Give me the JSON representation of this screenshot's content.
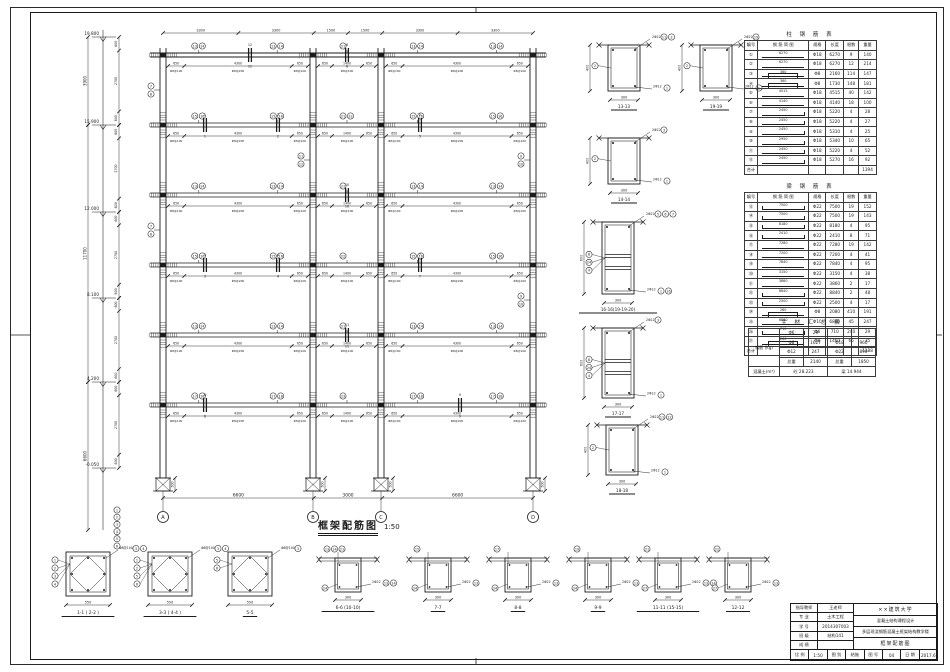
{
  "sheet": {
    "bg": "#ffffff",
    "line_color": "#1b1b1b"
  },
  "drawing_title": {
    "text": "框架配筋图",
    "scale": "1:50"
  },
  "axes": {
    "ids": [
      "A",
      "B",
      "C",
      "D"
    ],
    "x": [
      163,
      313,
      381,
      533
    ],
    "span_labels": [
      "6600",
      "3000",
      "6600"
    ],
    "top_segs": [
      "3300",
      "3300",
      "1500",
      "1500",
      "3300",
      "3300"
    ]
  },
  "levels": [
    {
      "y": 37,
      "label": "19.800"
    },
    {
      "y": 125,
      "label": "15.900"
    },
    {
      "y": 212,
      "label": "12.000"
    },
    {
      "y": 298,
      "label": "8.100"
    },
    {
      "y": 382,
      "label": "4.200"
    },
    {
      "y": 468,
      "label": "-0.050"
    }
  ],
  "left_total_dims": [
    {
      "y1": 37,
      "y2": 125,
      "label": "3900"
    },
    {
      "y1": 125,
      "y2": 382,
      "label": "11700"
    },
    {
      "y1": 382,
      "y2": 530,
      "label": "6600"
    }
  ],
  "story_sub_dims": [
    "600",
    "2700",
    "600"
  ],
  "beams": {
    "y": [
      55,
      125,
      195,
      265,
      335,
      405
    ],
    "x1": 150,
    "x2": 546,
    "col_top": 48,
    "col_bottom": 478,
    "side_dims": [
      "650",
      "4300",
      "650"
    ],
    "mid_dims": [
      "650",
      "1400",
      "650"
    ],
    "stirrups": [
      "Φ8@100",
      "Φ8@200",
      "Φ8@100"
    ],
    "marks": [
      [
        [
          "13",
          "14"
        ],
        [
          "21"
        ],
        [
          "13",
          "14"
        ]
      ],
      [
        [
          "15",
          "16"
        ],
        [
          "21",
          "22"
        ],
        [
          "15",
          "16"
        ]
      ],
      [
        [
          "13",
          "14"
        ],
        [
          "21"
        ],
        [
          "13",
          "14"
        ]
      ],
      [
        [
          "15",
          "16"
        ],
        [
          "22"
        ],
        [
          "15",
          "16"
        ]
      ],
      [
        [
          "13",
          "14"
        ],
        [
          "21"
        ],
        [
          "13",
          "14"
        ]
      ],
      [
        [
          "17",
          "18"
        ],
        [
          "23"
        ],
        [
          "17",
          "18"
        ]
      ]
    ]
  },
  "cuts": [
    {
      "x": 205,
      "l": 1,
      "n": "1"
    },
    {
      "x": 278,
      "l": 1,
      "n": "2"
    },
    {
      "x": 205,
      "l": 3,
      "n": "3"
    },
    {
      "x": 278,
      "l": 3,
      "n": "4"
    },
    {
      "x": 420,
      "l": 1,
      "n": "5"
    },
    {
      "x": 347,
      "l": 0,
      "n": "6"
    },
    {
      "x": 420,
      "l": 3,
      "n": "7"
    },
    {
      "x": 205,
      "l": 5,
      "n": "8"
    },
    {
      "x": 460,
      "l": 5,
      "n": "9"
    },
    {
      "x": 347,
      "l": 2,
      "n": "10"
    },
    {
      "x": 347,
      "l": 4,
      "n": "11"
    },
    {
      "x": 250,
      "l": 0,
      "n": "12"
    }
  ],
  "col_marks": [
    {
      "x": 163,
      "story": 1,
      "nums": [
        "7",
        "8"
      ]
    },
    {
      "x": 163,
      "story": 3,
      "nums": [
        "7",
        "8"
      ]
    },
    {
      "x": 533,
      "story": 2,
      "nums": [
        "9",
        "10"
      ]
    },
    {
      "x": 533,
      "story": 4,
      "nums": [
        "9",
        "10"
      ]
    },
    {
      "x": 313,
      "story": 2,
      "nums": [
        "11",
        "12"
      ]
    }
  ],
  "axis_legend": [
    "1",
    "2",
    "3",
    "4",
    "5",
    "6"
  ],
  "foundation_dim": "500",
  "mid_sections": [
    {
      "label": "13-13",
      "x": 608,
      "y": 45,
      "w": 32,
      "h": 46,
      "hdim": "400",
      "wdim": "300",
      "top": "2Φ22",
      "topc": [
        "11",
        "3"
      ],
      "bot": "2Φ12",
      "botc": [
        "1"
      ],
      "leftc": [
        "2"
      ],
      "mid": false
    },
    {
      "label": "19-19",
      "x": 700,
      "y": 45,
      "w": 32,
      "h": 46,
      "hdim": "400",
      "wdim": "300",
      "top": "2Φ22",
      "topc": [
        "19"
      ],
      "bot": "2Φ12",
      "botc": [
        "1"
      ],
      "leftc": [
        "2"
      ],
      "mid": false
    },
    {
      "label": "14-14",
      "x": 608,
      "y": 138,
      "w": 32,
      "h": 46,
      "hdim": "400",
      "wdim": "300",
      "top": "2Φ22",
      "topc": [
        "3"
      ],
      "bot": "2Φ12",
      "botc": [
        "1"
      ],
      "leftc": [
        "2"
      ],
      "mid": false
    },
    {
      "label": "16-16(19-19-20)",
      "x": 602,
      "y": 222,
      "w": 32,
      "h": 72,
      "hdim": "600",
      "wdim": "300",
      "top": "2Φ22",
      "topc": [
        "5",
        "6",
        "7"
      ],
      "bot": "2Φ12",
      "botc": [
        "1",
        "16"
      ],
      "leftc": [
        "8",
        "24",
        "4"
      ],
      "mid": true
    },
    {
      "label": "17-17",
      "x": 602,
      "y": 328,
      "w": 32,
      "h": 70,
      "hdim": "600",
      "wdim": "300",
      "top": "2Φ22",
      "topc": [
        "3"
      ],
      "bot": "2Φ12",
      "botc": [
        "1"
      ],
      "leftc": [
        "8",
        "24",
        "4"
      ],
      "mid": true
    },
    {
      "label": "18-18",
      "x": 606,
      "y": 425,
      "w": 32,
      "h": 50,
      "hdim": "400",
      "wdim": "300",
      "top": "2Φ22",
      "topc": [
        "11",
        "12"
      ],
      "bot": "2Φ12",
      "botc": [
        "1"
      ],
      "leftc": [
        "2"
      ],
      "mid": false
    }
  ],
  "bottom_sections": [
    {
      "label": "1-1 ( 2-2 )",
      "cx": 88,
      "type": "column",
      "wdim": "550",
      "leftc": [
        "1",
        "2",
        "3",
        "4"
      ],
      "rightc": [
        "3",
        "4"
      ],
      "note": "Φ8@100"
    },
    {
      "label": "3-3 ( 4-4 )",
      "cx": 170,
      "type": "column",
      "wdim": "550",
      "leftc": [
        "1",
        "2",
        "5",
        "6"
      ],
      "rightc": [
        "3",
        "4"
      ],
      "note": "Φ8@100"
    },
    {
      "label": "5-5",
      "cx": 250,
      "type": "column",
      "wdim": "550",
      "leftc": [
        "5",
        "6"
      ],
      "rightc": [
        "3"
      ],
      "note": "Φ8@100"
    },
    {
      "label": "6-6 (10-10)",
      "cx": 348,
      "type": "beam",
      "wdim": "300",
      "topc": [
        "13",
        "14",
        "21"
      ],
      "rightc": [
        "13",
        "14"
      ],
      "leftc": [
        "24"
      ],
      "top": "2Φ22"
    },
    {
      "label": "7-7",
      "cx": 438,
      "type": "beam",
      "wdim": "300",
      "topc": [
        "15"
      ],
      "rightc": [
        "13"
      ],
      "leftc": [
        "24"
      ],
      "top": "2Φ22"
    },
    {
      "label": "8-8",
      "cx": 518,
      "type": "beam",
      "wdim": "300",
      "topc": [
        "17"
      ],
      "rightc": [
        "13"
      ],
      "leftc": [
        "24"
      ],
      "top": "2Φ22"
    },
    {
      "label": "9-9",
      "cx": 598,
      "type": "beam",
      "wdim": "300",
      "topc": [
        "19"
      ],
      "rightc": [
        "13"
      ],
      "leftc": [
        "24"
      ],
      "top": "2Φ22"
    },
    {
      "label": "11-11 (15-15)",
      "cx": 668,
      "type": "beam",
      "wdim": "300",
      "topc": [
        "21"
      ],
      "rightc": [
        "13",
        "14"
      ],
      "leftc": [
        "27"
      ],
      "top": "2Φ22"
    },
    {
      "label": "12-12",
      "cx": 738,
      "type": "beam",
      "wdim": "300",
      "topc": [
        "22"
      ],
      "rightc": [
        "13"
      ],
      "leftc": [
        "27"
      ],
      "top": "2Φ22"
    }
  ],
  "column_table": {
    "title": "柱 钢 筋 表",
    "x": 744,
    "y": 30,
    "headers": [
      "编号",
      "钢 筋 简 图",
      "规格",
      "长度",
      "根数",
      "重量"
    ],
    "rows": [
      {
        "no": "①",
        "shape": "line",
        "dlabel": "6270",
        "spec": "Φ18",
        "len": "6270",
        "cnt": "9",
        "wt": "140"
      },
      {
        "no": "②",
        "shape": "line",
        "dlabel": "6270",
        "spec": "Φ18",
        "len": "6270",
        "cnt": "12",
        "wt": "214"
      },
      {
        "no": "③",
        "shape": "stir",
        "dlabel": "360",
        "spec": "Φ8",
        "len": "2160",
        "cnt": "114",
        "wt": "147"
      },
      {
        "no": "④",
        "shape": "stir",
        "dlabel": "360",
        "spec": "Φ8",
        "len": "1730",
        "cnt": "148",
        "wt": "181"
      },
      {
        "no": "⑤",
        "shape": "line",
        "dlabel": "4515",
        "spec": "Φ18",
        "len": "4515",
        "cnt": "40",
        "wt": "142"
      },
      {
        "no": "⑥",
        "shape": "line",
        "dlabel": "4140",
        "spec": "Φ18",
        "len": "4140",
        "cnt": "18",
        "wt": "100"
      },
      {
        "no": "⑦",
        "shape": "hookR",
        "dlabel": "2450",
        "spec": "Φ18",
        "len": "5220",
        "cnt": "4",
        "wt": "28"
      },
      {
        "no": "⑧",
        "shape": "hookR",
        "dlabel": "2450",
        "spec": "Φ18",
        "len": "5220",
        "cnt": "4",
        "wt": "27"
      },
      {
        "no": "⑨",
        "shape": "hookR",
        "dlabel": "2450",
        "spec": "Φ18",
        "len": "5310",
        "cnt": "4",
        "wt": "25"
      },
      {
        "no": "⑩",
        "shape": "hookR",
        "dlabel": "2950",
        "spec": "Φ18",
        "len": "5340",
        "cnt": "10",
        "wt": "65"
      },
      {
        "no": "⑪",
        "shape": "hookR",
        "dlabel": "2450",
        "spec": "Φ18",
        "len": "5220",
        "cnt": "4",
        "wt": "52"
      },
      {
        "no": "⑫",
        "shape": "hookR",
        "dlabel": "2450",
        "spec": "Φ18",
        "len": "5270",
        "cnt": "16",
        "wt": "92"
      }
    ],
    "total_label": "合计",
    "total": "1394"
  },
  "beam_table": {
    "title": "梁 钢 筋 表",
    "x": 744,
    "y": 182,
    "headers": [
      "编号",
      "钢 筋 简 图",
      "规格",
      "长度",
      "根数",
      "重量"
    ],
    "rows": [
      {
        "no": "⑬",
        "shape": "hookLR",
        "dlabel": "7500",
        "spec": "Φ22",
        "len": "7500",
        "cnt": "19",
        "wt": "152"
      },
      {
        "no": "⑭",
        "shape": "hookLR",
        "dlabel": "7500",
        "spec": "Φ22",
        "len": "7500",
        "cnt": "19",
        "wt": "143"
      },
      {
        "no": "⑮",
        "shape": "hookLR",
        "dlabel": "8180",
        "spec": "Φ22",
        "len": "8180",
        "cnt": "4",
        "wt": "95"
      },
      {
        "no": "⑯",
        "shape": "hookLR",
        "dlabel": "2410",
        "spec": "Φ22",
        "len": "2410",
        "cnt": "8",
        "wt": "71"
      },
      {
        "no": "⑰",
        "shape": "line",
        "dlabel": "7280",
        "spec": "Φ22",
        "len": "7280",
        "cnt": "19",
        "wt": "142"
      },
      {
        "no": "⑱",
        "shape": "line",
        "dlabel": "7200",
        "spec": "Φ22",
        "len": "7200",
        "cnt": "4",
        "wt": "41"
      },
      {
        "no": "⑲",
        "shape": "line",
        "dlabel": "7840",
        "spec": "Φ22",
        "len": "7840",
        "cnt": "4",
        "wt": "95"
      },
      {
        "no": "⑳",
        "shape": "line",
        "dlabel": "3150",
        "spec": "Φ22",
        "len": "3150",
        "cnt": "4",
        "wt": "38"
      },
      {
        "no": "㉑",
        "shape": "line",
        "dlabel": "3860",
        "spec": "Φ22",
        "len": "3860",
        "cnt": "2",
        "wt": "17"
      },
      {
        "no": "㉒",
        "shape": "hookLR",
        "dlabel": "8840",
        "spec": "Φ22",
        "len": "8840",
        "cnt": "2",
        "wt": "48"
      },
      {
        "no": "㉓",
        "shape": "hookLR",
        "dlabel": "2500",
        "spec": "Φ22",
        "len": "2500",
        "cnt": "4",
        "wt": "17"
      },
      {
        "no": "㉔",
        "shape": "stir",
        "dlabel": "260",
        "spec": "Φ8",
        "len": "2080",
        "cnt": "410",
        "wt": "191"
      },
      {
        "no": "㉕",
        "shape": "line",
        "dlabel": "6860",
        "spec": "Φ10",
        "len": "6860",
        "cnt": "45",
        "wt": "247"
      },
      {
        "no": "㉖",
        "shape": "hookLR",
        "dlabel": "710",
        "spec": "Φ6",
        "len": "710",
        "cnt": "240",
        "wt": "29"
      },
      {
        "no": "㉗",
        "shape": "stir",
        "dlabel": "260",
        "spec": "Φ8",
        "len": "1460",
        "cnt": "65",
        "wt": "35"
      }
    ],
    "total_label": "合计",
    "total": "1188"
  },
  "summary_table": {
    "title": "主 材 汇 总 表",
    "x": 748,
    "y": 318,
    "rebar_label": "钢筋 (kg)",
    "rows": [
      [
        "Φ6",
        "29",
        "",
        ""
      ],
      [
        "Φ8",
        "1627",
        "Φ18",
        "960"
      ],
      [
        "Φ12",
        "247",
        "Φ22",
        "890"
      ],
      [
        "总重",
        "2140",
        "总重",
        "1850"
      ]
    ],
    "concrete": [
      "混凝土(m³)",
      "砼 28.223",
      "梁 14.944"
    ]
  },
  "titleblock": {
    "left": [
      [
        "指导教师",
        "王老师"
      ],
      [
        "专  业",
        "土木工程"
      ],
      [
        "学  号",
        "2014307003"
      ],
      [
        "班  级",
        "结构141"
      ],
      [
        "成  绩",
        ""
      ]
    ],
    "school": "××建筑大学",
    "course": "混凝土结构课程设计",
    "project": "多层现浇钢筋混凝土框架结构教学楼",
    "drawing": "框架配筋图",
    "bottom_cells": [
      "比 例",
      "1:50",
      "图 别",
      "结施",
      "图 号",
      "04",
      "日 期",
      "2017.6"
    ]
  }
}
